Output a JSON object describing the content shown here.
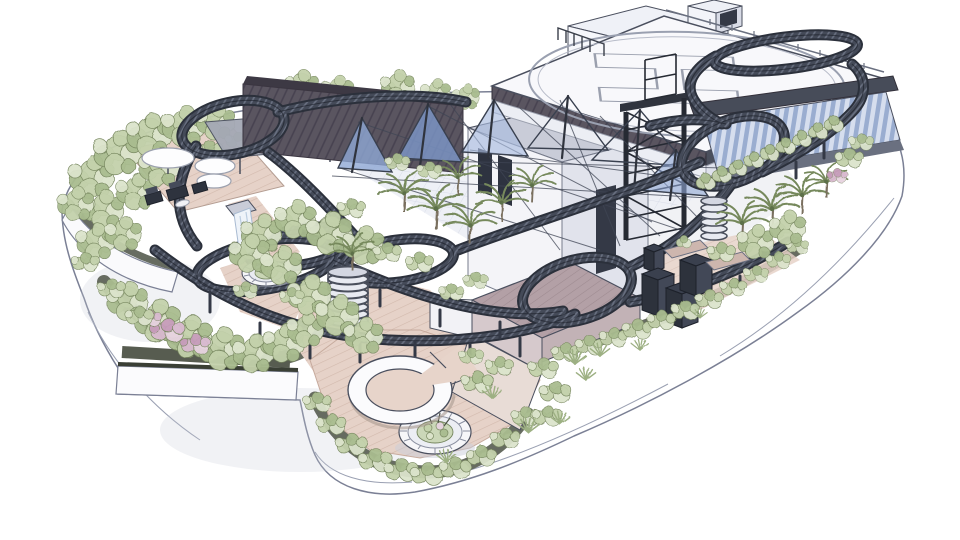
{
  "scene": {
    "description": "Hand-drawn architectural concept sketch of a rooftop garden deck with a helipad, a looping elevated ride track, blue tensile sail canopies, terraces, planters and lush sketched vegetation on a white background."
  },
  "helipad": {
    "marking": "H"
  },
  "palette": {
    "paper": "#ffffff",
    "ink": "#4a4f5e",
    "track_dark": "#3a3f4b",
    "building_light": "#f4f4f8",
    "building_shade": "#dfe1ea",
    "dark_structure": "#2f333d",
    "glass_blue": "#93a7cb",
    "sail_blue": "#8fa7d4",
    "foliage_light": "#dce4cc",
    "foliage_mid": "#b9c9a3",
    "foliage_dark": "#8fa678",
    "flower_pink": "#cfa9c4",
    "paving_pink": "#e6d2c8",
    "ramp_mauve": "#b3a0a6",
    "fascia_white": "#fbfbfd"
  },
  "features": {
    "helipad": "rooftop helipad with H marking",
    "penthouse": "rooftop penthouse volumes",
    "coaster_track": "looping elevated track",
    "cable_sails": "blue tensile sail canopies",
    "elevator_tower": "steel truss tower",
    "glass_facade": "glazed facade under helipad deck",
    "gardens": "sketched shrub, flower and palm gardens",
    "crescent_bench": "crescent seating bench",
    "circular_planters": "segmented circular planters",
    "ramp": "sunken access ramp",
    "parasols": "terrace parasols and lounge seating",
    "spiral_stairs": "spiral stair drums",
    "hvac_cubes": "dark equipment cubes"
  }
}
